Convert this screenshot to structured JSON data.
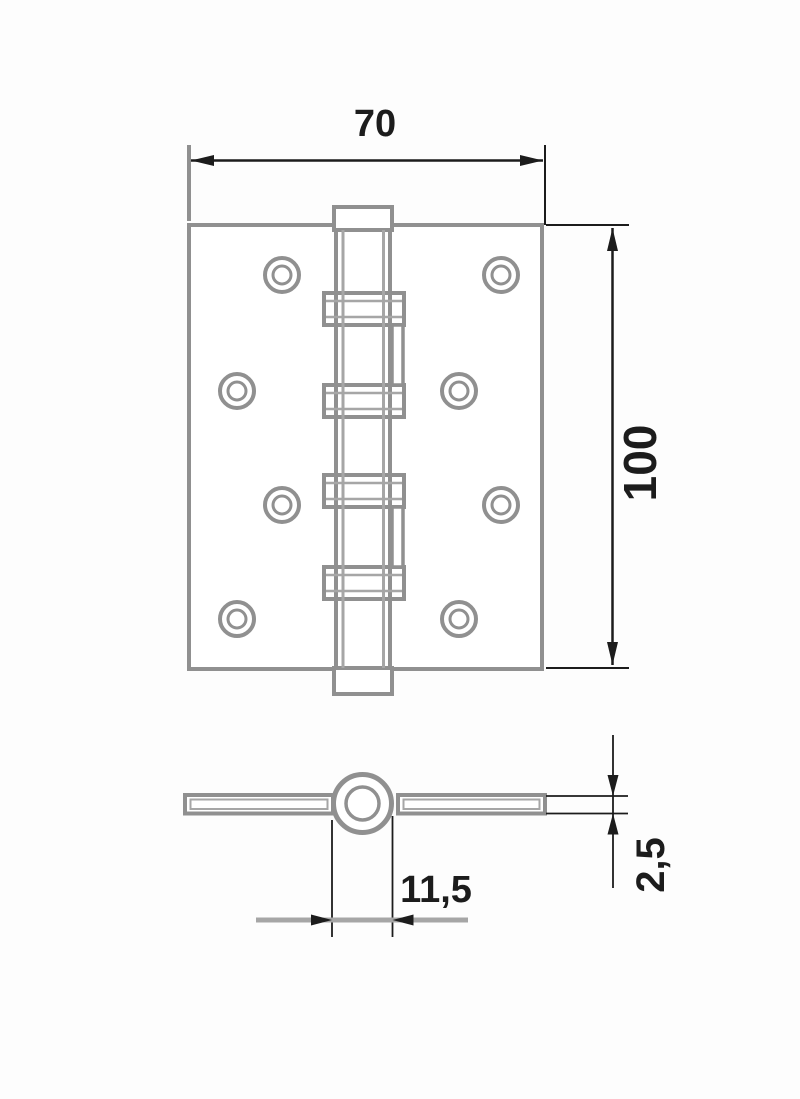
{
  "dimensions": {
    "plate_width": {
      "label": "70"
    },
    "plate_height": {
      "label": "100"
    },
    "barrel_diameter": {
      "label": "11,5"
    },
    "leaf_thickness": {
      "label": "2,5"
    }
  },
  "colors": {
    "drawing_line": "#909090",
    "light_line": "#a6a6a6",
    "dimension_line": "#1c1c1c"
  }
}
